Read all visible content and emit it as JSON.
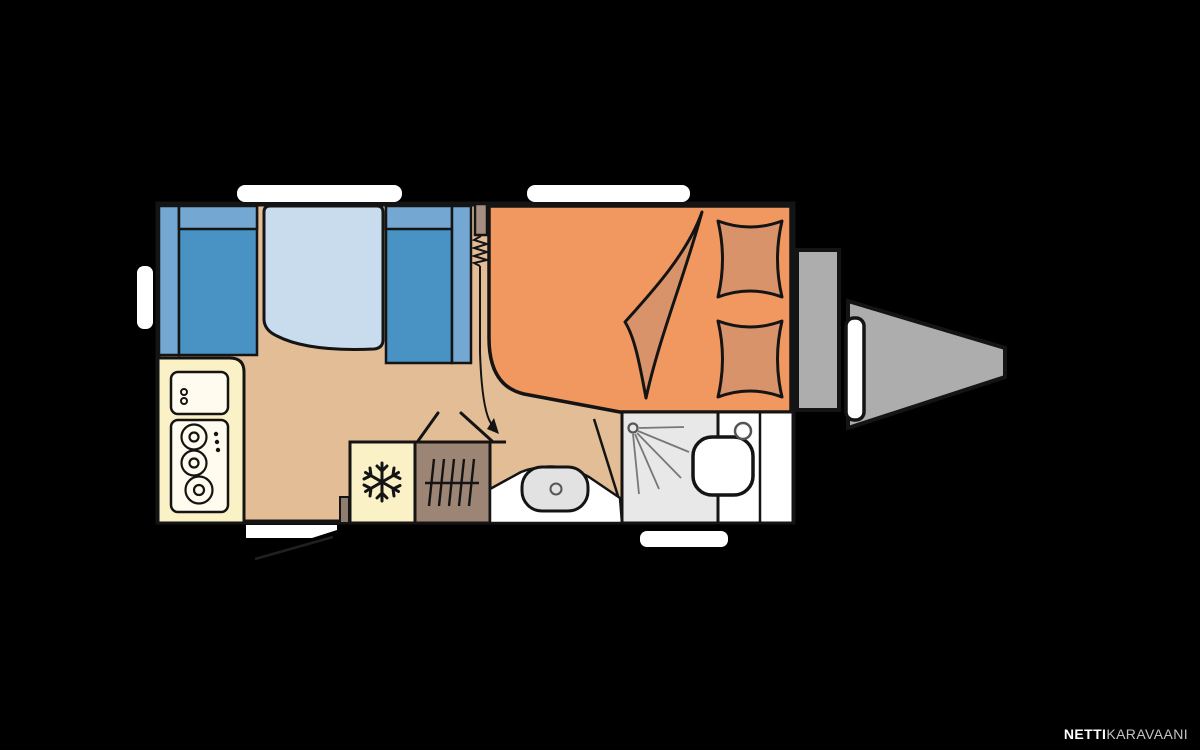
{
  "page": {
    "title": "Caravan floor plan",
    "description": "Top-down floor plan of a travel trailer on black background"
  },
  "watermark": {
    "bold": "NETTI",
    "light": "KARAVAANI"
  },
  "colors": {
    "background": "#000000",
    "outline": "#141414",
    "floor": "#E2BD96",
    "bench_seat": "#4892C4",
    "bench_back": "#74A7D1",
    "table": "#C8DCEE",
    "bed": "#F0985F",
    "bedding": "#D9936A",
    "divider_wood": "#A68F80",
    "kitchen": "#FAF1C6",
    "appliance": "#FFFBEE",
    "wardrobe": "#9C8575",
    "wardrobe_dark": "#8F7E6F",
    "white_area": "#FFFFFF",
    "shower": "#E8E8E8",
    "basin": "#E2E2E2",
    "metal": "#ADADAD",
    "marker": "#FFFFFF",
    "swing_line": "#202020",
    "shower_detail": "#777777",
    "detail_gray": "#555555",
    "watermark_bold": "#FFFFFF",
    "watermark_light": "#C4C4C4"
  }
}
